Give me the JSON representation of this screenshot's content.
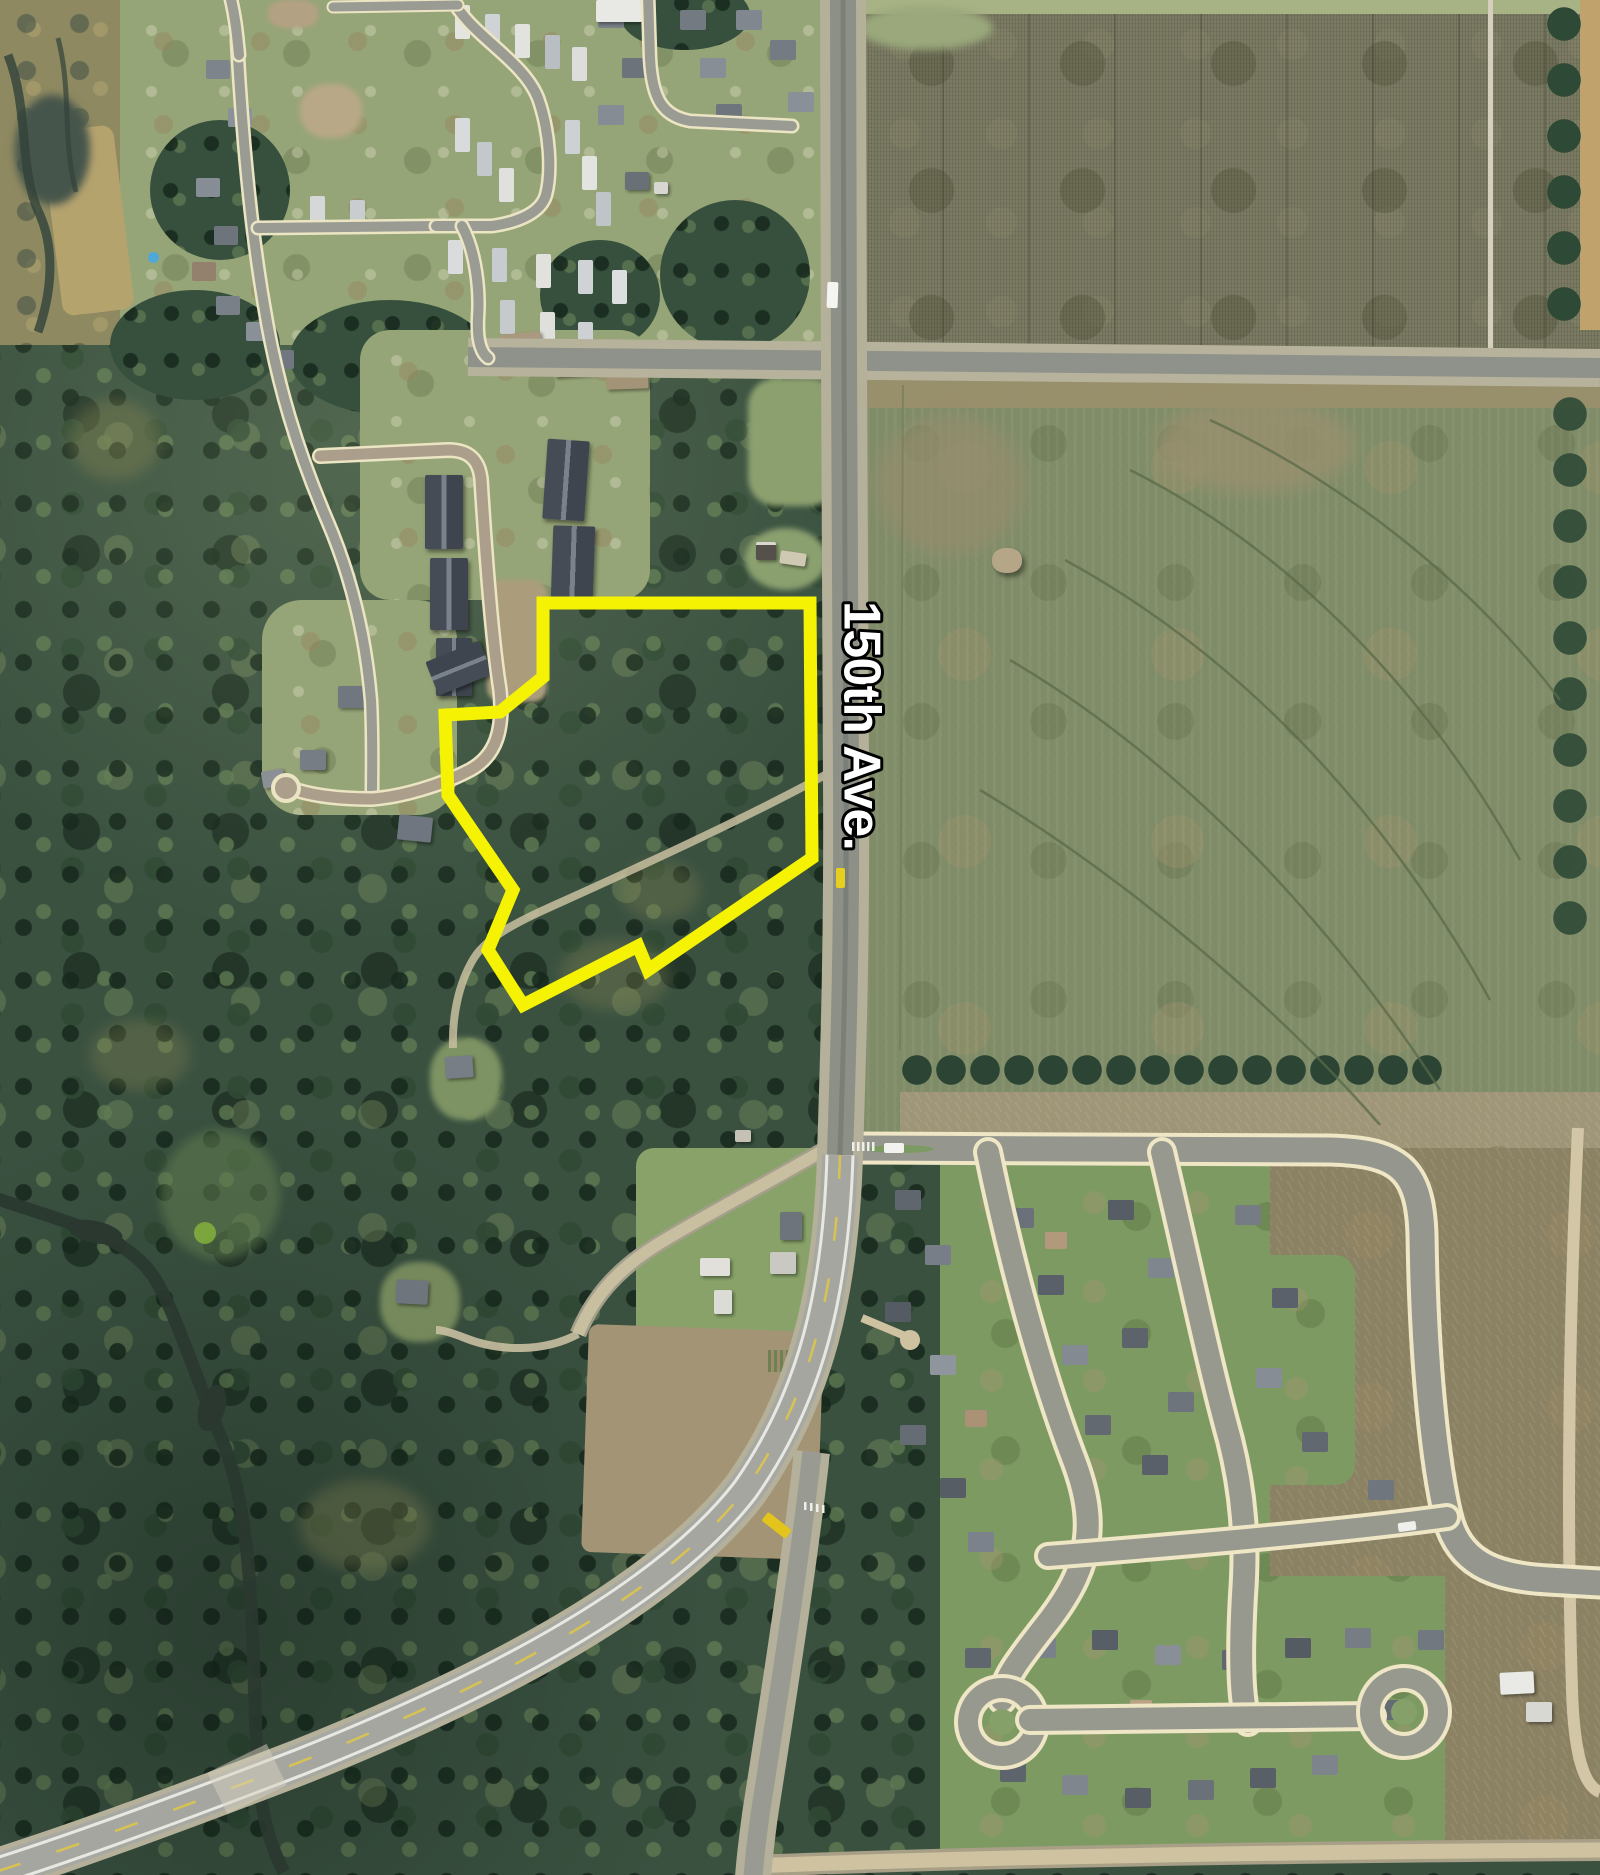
{
  "map": {
    "road_label": "150th Ave.",
    "label": {
      "fill": "#FFFFFF",
      "outline": "#000000"
    },
    "parcel": {
      "points": "543,603 810,603 812,858 648,970 638,946 523,1005 488,950 513,890 448,795 445,715 500,712 543,677",
      "color": "#F5F303",
      "width": "13"
    },
    "vehicles": {
      "truck_on_150th": "#F4F4F0",
      "car_on_entrance_road": "#F2F2EE",
      "yellow_car_on_150th": "#E6CF1D",
      "yellow_bus_on_highway": "#E3C41D",
      "car_on_cross_street": "#EFEFEB"
    }
  }
}
